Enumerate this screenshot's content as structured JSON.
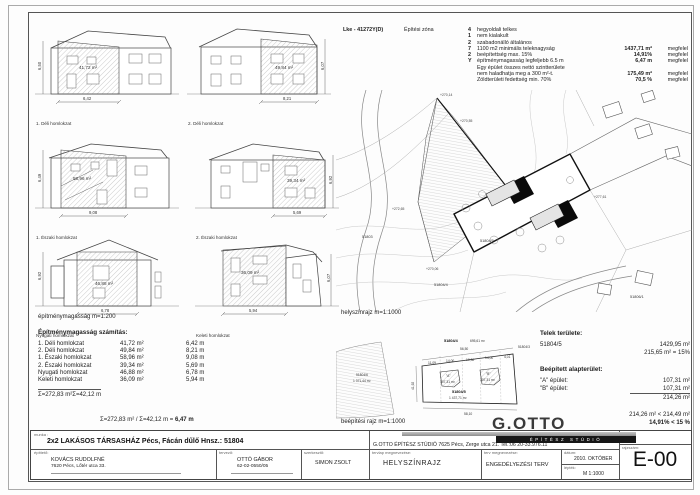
{
  "zone": {
    "code": "Lke - 41272Y(D)",
    "title": "Építési zóna",
    "rows": [
      {
        "n": "4",
        "t": "hegyoldali telkes",
        "v": "",
        "s": ""
      },
      {
        "n": "1",
        "t": "nem kialakult",
        "v": "",
        "s": ""
      },
      {
        "n": "2",
        "t": "szabadonálló általános",
        "v": "",
        "s": ""
      },
      {
        "n": "7",
        "t": "1100 m2 minimális teleknagyság",
        "v": "1437,71 m²",
        "s": "megfelel"
      },
      {
        "n": "2",
        "t": "beépítettség max. 15%",
        "v": "14,91%",
        "s": "megfelel"
      },
      {
        "n": "Y",
        "t": "építménymagasság legfeljebb 6.5 m",
        "v": "6,47 m",
        "s": "megfelel"
      },
      {
        "n": "",
        "t": "Egy épület összes nettó szintterülete",
        "v": "",
        "s": ""
      },
      {
        "n": "",
        "t": "nem haladhatja meg a 300 m²-t.",
        "v": "175,49 m²",
        "s": "megfelel"
      },
      {
        "n": "",
        "t": "Zöldterületi fedettség min. 70%",
        "v": "70,5 %",
        "s": "megfelel"
      }
    ]
  },
  "elevations": [
    {
      "label": "1. Déli homlokzat",
      "area": "41,72 m²",
      "w": "6,42",
      "h": "6,50"
    },
    {
      "label": "2. Déli homlokzat",
      "area": "49,84 m²",
      "w": "8,21",
      "h": "6,07"
    },
    {
      "label": "1. Északi homlokzat",
      "area": "58,96 m²",
      "w": "9,08",
      "h": "6,49"
    },
    {
      "label": "2. Északi homlokzat",
      "area": "39,34 m²",
      "w": "5,69",
      "h": "6,92"
    },
    {
      "label": "Nyugati homlokzat",
      "area": "46,88 m²",
      "w": "6,78",
      "h": "6,92"
    },
    {
      "label": "Keleti homlokzat",
      "area": "36,09 m²",
      "w": "5,94",
      "h": "6,07"
    }
  ],
  "captions": {
    "elev_scale": "építménymagasság m=1:200",
    "siteplan": "helyszínrajz m=1:1000",
    "layout": "beépítési rajz m=1:1000"
  },
  "calc": {
    "title": "Építménymagasság számítás:",
    "rows": [
      {
        "name": "1. Déli homlokzat",
        "area": "41,72 m²",
        "len": "6,42 m"
      },
      {
        "name": "2. Déli homlokzat",
        "area": "49,84 m²",
        "len": "8,21 m"
      },
      {
        "name": "1. Északi homlokzat",
        "area": "58,96 m²",
        "len": "9,08 m"
      },
      {
        "name": "2. Északi homlokzat",
        "area": "39,34 m²",
        "len": "5,69 m"
      },
      {
        "name": "Nyugati homlokzat",
        "area": "46,88 m²",
        "len": "6,78 m"
      },
      {
        "name": "Keleti homlokzat",
        "area": "36,09 m²",
        "len": "5,94 m"
      }
    ],
    "sum_area": "Σ=272,83 m²",
    "sum_len": "Σ=42,12 m",
    "formula": "Σ=272,83 m² / Σ=42,12 m = ",
    "result": "6,47 m"
  },
  "plot": {
    "title": "Telek területe:",
    "parcel": "51804/5",
    "area": "1429,95 m²",
    "allowed": "215,65 m² = 15%",
    "built_title": "Beépített alapterület:",
    "a_label": "\"A\" épület:",
    "a_area": "107,31 m²",
    "b_label": "\"B\" épület:",
    "b_area": "107,31 m²",
    "total": "214,26 m²",
    "check_area": "214,26 m² < 214,49 m²",
    "check_pct": "14,91% < 15 %"
  },
  "siteplan": {
    "spots": [
      "+270,14",
      "+270,55",
      "+272,65",
      "+270,06",
      "+277,61"
    ],
    "parcels": [
      "51803",
      "51804/5",
      "51804/4",
      "51806/1"
    ]
  },
  "layoutplan": {
    "top_parcel": "51804/4",
    "top_parcel_area": "695,61 m²",
    "right_parcel": "51804/3",
    "left_parcel": "51804/6",
    "left_parcel_area": "1 371,44 m²",
    "parcel": "51804/5",
    "parcel_area": "1 437,71 m²",
    "a": "\"A\"",
    "a_area": "107,31 m²",
    "b": "\"B\"",
    "b_area": "107,31 m²",
    "dim_top": "56,50",
    "dims": [
      "11,09",
      "14,00",
      "10,30",
      "14,00",
      "4,01"
    ],
    "dim_bottom": "58,10",
    "dim_left": "41,92"
  },
  "titleblock": {
    "munka_label": "munka :",
    "project": "2x2 LAKÁSOS TÁRSASHÁZ Pécs, Fácán dűlő  Hnsz.: 51804",
    "client_label": "építtető:",
    "client_name": "KOVÁCS RUDOLFNÉ",
    "client_addr": "7620 Pécs, Lőtér utca 33.",
    "designer_label": "tervező:",
    "designer_name": "OTTÓ GÁBOR",
    "designer_reg": "62-02-0550/05",
    "editor_label": "szerkesztő:",
    "editor_name": "SIMON ZSOLT",
    "logo": "G.OTTO",
    "logo_sub": "ÉPÍTÉSZ STÚDIÓ",
    "studio_line": "G.OTTO ÉPÍTÉSZ STÚDIÓ 7625  Pécs, Zerge utca 21. Tel.:06 20-33.976.11",
    "sheet_label": "tervlap megnevezése:",
    "sheet_name": "HELYSZÍNRAJZ",
    "plan_label": "terv megnevezése:",
    "plan_name": "ENGEDÉLYEZÉSI TERV",
    "date_label": "dátum:",
    "date": "2010. OKTÓBER",
    "scale_label": "lépték:",
    "scale": "M 1:1000",
    "number_label": "rajzszám:",
    "number": "E-00"
  }
}
